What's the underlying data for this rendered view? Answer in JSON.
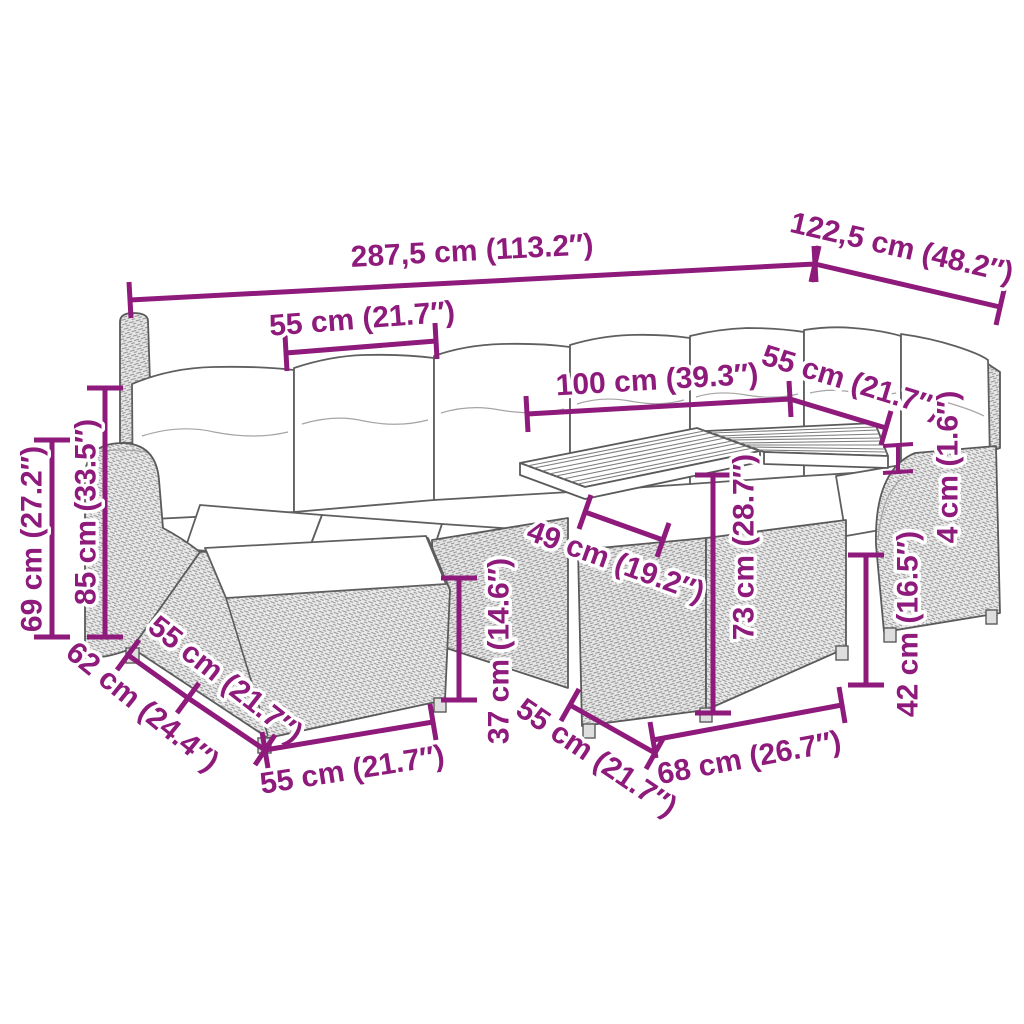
{
  "diagram": {
    "accent_color": "#8e1a7b",
    "line_color": "#5a5a5a",
    "labels": {
      "overall_width": "287,5 cm (113.2″)",
      "overall_depth": "122,5 cm (48.2″)",
      "back_cushion_width": "55 cm (21.7″)",
      "table_length": "100 cm (39.3″)",
      "right_seat_width": "55 cm (21.7″)",
      "top_thickness": "4 cm (1.6″)",
      "arm_height": "69 cm (27.2″)",
      "back_height": "85 cm (33.5″)",
      "table_clearance": "49 cm (19.2″)",
      "ottoman_height": "37 cm (14.6″)",
      "table_height": "73 cm (28.7″)",
      "side_height": "42 cm (16.5″)",
      "ottoman_depth": "62 cm (24.4″)",
      "ottoman_side_width": "55 cm (21.7″)",
      "ottoman_front_width": "55 cm (21.7″)",
      "table_side_depth": "55 cm (21.7″)",
      "table_front_width": "68 cm (26.7″)"
    }
  }
}
